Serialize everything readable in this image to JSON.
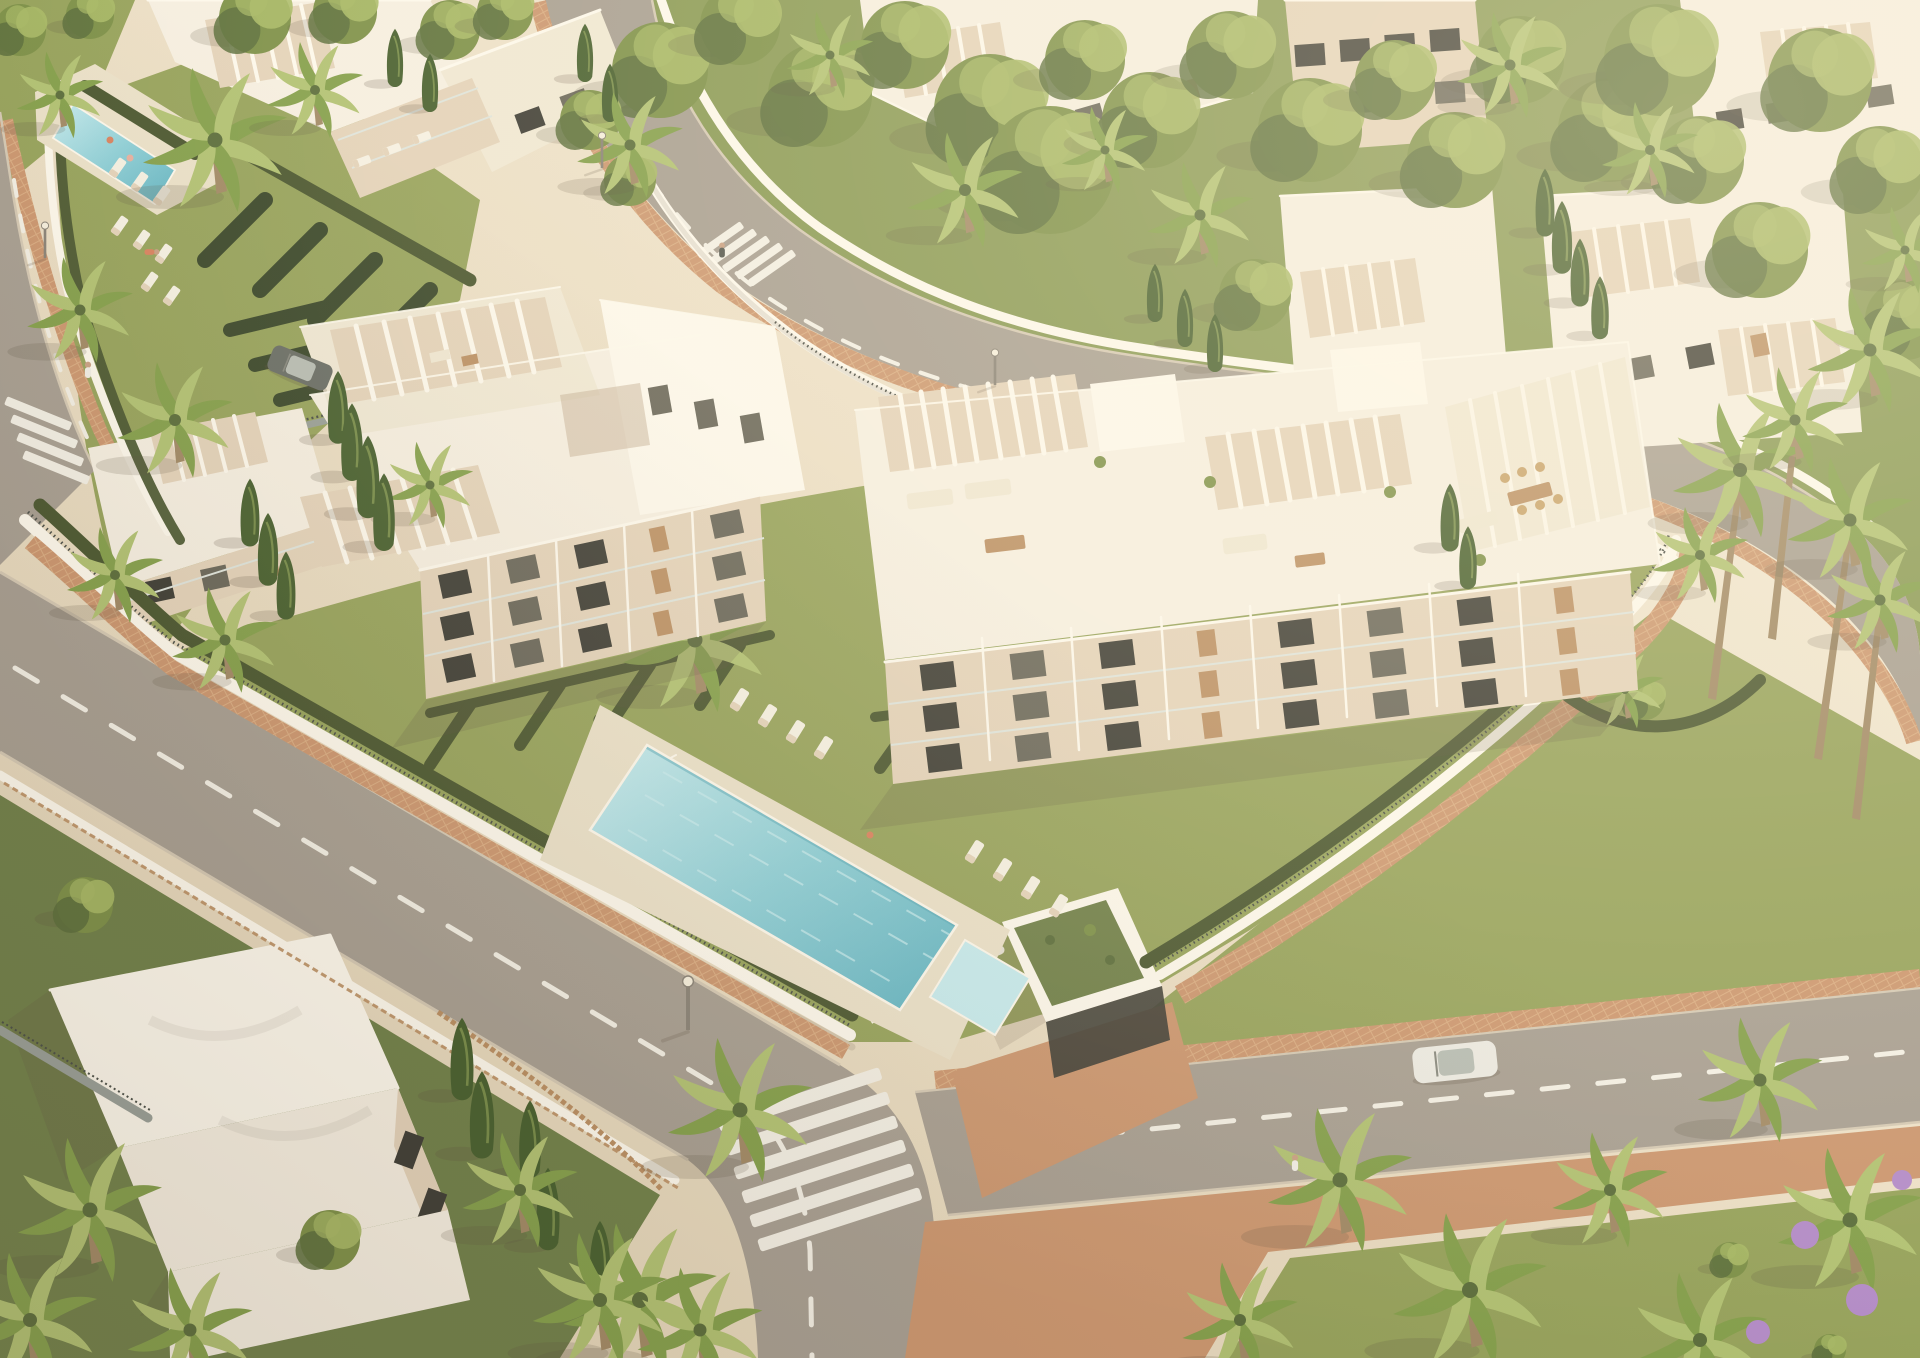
{
  "scene": {
    "kind": "aerial-architectural-render",
    "subject": "white modern apartment complex with communal pool, perimeter roads and palm trees at sunset light",
    "palette": {
      "ground": "#e6d9bd",
      "ground_light": "#f5eedc",
      "park_green": "#8a9a55",
      "lawn": "#97a35c",
      "lawn_light": "#b3b46b",
      "lawn_dark": "#71814a",
      "hedge": "#4c5831",
      "hedge_dark": "#3b482b",
      "tree": "#7e9149",
      "tree_light": "#a8b966",
      "tree_dark": "#5c6e3c",
      "cypress": "#48602f",
      "palm": "#85a04c",
      "palm_light": "#b2c273",
      "trunk": "#a28a66",
      "building": "#f6efe1",
      "building_bright": "#fdf8ec",
      "building_shade": "#e4d3ba",
      "building_dark": "#c3ae93",
      "roof": "#f0e8d4",
      "wood": "#bb9064",
      "glass": "#6a675a",
      "glass_dark": "#3f3e36",
      "road": "#a89f92",
      "road_light": "#bdb2a2",
      "marking": "#f3efe4",
      "curb": "#d5c9b4",
      "brick": "#cc9770",
      "brick_light": "#e0b68c",
      "deck": "#ebe1c9",
      "pool": "#8fd0d8",
      "pool_light": "#c7ebee",
      "pool_deep": "#62b4c2",
      "fence": "#4b4f48",
      "lounger": "#f6f1e3",
      "shadow": "#5e5140",
      "flower": "#b48cc8",
      "car": "#eceae2",
      "car_dark": "#6a6e66",
      "person_skin": "#caa184"
    },
    "objects": [
      "apartment-building",
      "rooftop-pergola",
      "roof-terrace",
      "balcony",
      "swimming-pool",
      "kids-pool",
      "pool-deck",
      "sun-lounger",
      "lawn",
      "hedge",
      "perimeter-wall",
      "metal-fence",
      "road",
      "lane-marking",
      "zebra-crossing",
      "brick-sidewalk",
      "palm-tree",
      "cypress-tree",
      "shade-tree",
      "street-lamp",
      "car",
      "pedestrian",
      "swimmer",
      "garage-entrance",
      "green-roof",
      "villa",
      "garden-gate",
      "flower-bush",
      "park"
    ]
  }
}
